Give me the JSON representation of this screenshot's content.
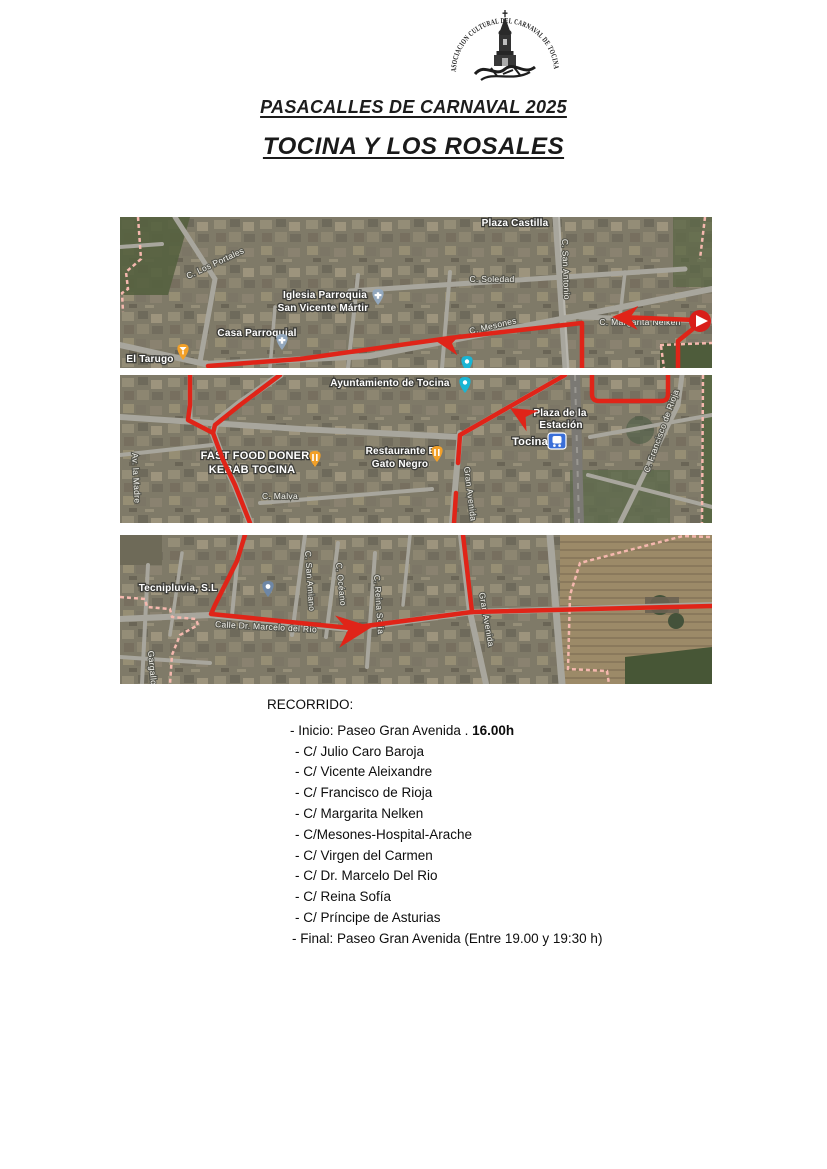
{
  "logo": {
    "seal_text": "ASOCIACION CULTURAL DEL CARNAVAL DE TOCINA"
  },
  "header": {
    "title": "PASACALLES DE CARNAVAL 2025",
    "subtitle": "TOCINA Y LOS ROSALES"
  },
  "colors": {
    "route": "#e02418",
    "boundary": "#f5b8ae",
    "marker_orange": "#f2a028",
    "marker_church": "#92a7bd",
    "marker_cyan": "#19b5d4",
    "marker_station": "#3a6fd8",
    "start_marker": "#d81f1a"
  },
  "maps": {
    "map1": {
      "labels": {
        "plaza_castilla": "Plaza Castilla",
        "c_soledad": "C. Soledad",
        "c_san_antonio": "C. San Antonio",
        "c_los_portales": "C. Los Portales",
        "iglesia_line1": "Iglesia Parroquia",
        "iglesia_line2": "San Vicente Mártir",
        "casa_parroquial": "Casa Parroquial",
        "el_tarugo": "El Tarugo",
        "c_mesones": "C. Mesones",
        "margarita_nelken": "C. Margarita Nelken"
      }
    },
    "map2": {
      "labels": {
        "ayuntamiento": "Ayuntamiento de Tocina",
        "fast_food_line1": "FAST FOOD DONER",
        "fast_food_line2": "KEBAB TOCINA",
        "restaurante_line1": "Restaurante El",
        "restaurante_line2": "Gato Negro",
        "c_malva": "C. Malva",
        "av_la_madre": "Av. la Madre",
        "plaza_line1": "Plaza de la",
        "plaza_line2": "Estación",
        "tocina_station": "Tocina",
        "gran_avenida": "Gran Avenida",
        "francisco_rioja": "C. Francisco de Rioja"
      }
    },
    "map3": {
      "labels": {
        "tecnipluvia": "Tecnipluvia, S.L",
        "marcelo_rio": "Calle Dr. Marcelo del Río",
        "san_amiano": "C. San Amiano",
        "oceano": "C. Océano",
        "reina_sofia": "C. Reina Sofía",
        "gran_avenida": "Gran Avenida",
        "gargallo": "Gargallo"
      }
    }
  },
  "recorrido": {
    "heading": "RECORRIDO:",
    "inicio_prefix": "- Inicio: Paseo Gran Avenida . ",
    "inicio_time": "16.00h",
    "streets": [
      "- C/ Julio Caro Baroja",
      "- C/ Vicente Aleixandre",
      "- C/ Francisco de Rioja",
      "- C/ Margarita Nelken",
      "- C/Mesones-Hospital-Arache",
      "- C/ Virgen del Carmen",
      "- C/ Dr. Marcelo Del Rio",
      "- C/ Reina Sofía",
      "- C/ Príncipe de Asturias"
    ],
    "final_line": "- Final: Paseo Gran Avenida (Entre 19.00 y 19:30 h)"
  }
}
